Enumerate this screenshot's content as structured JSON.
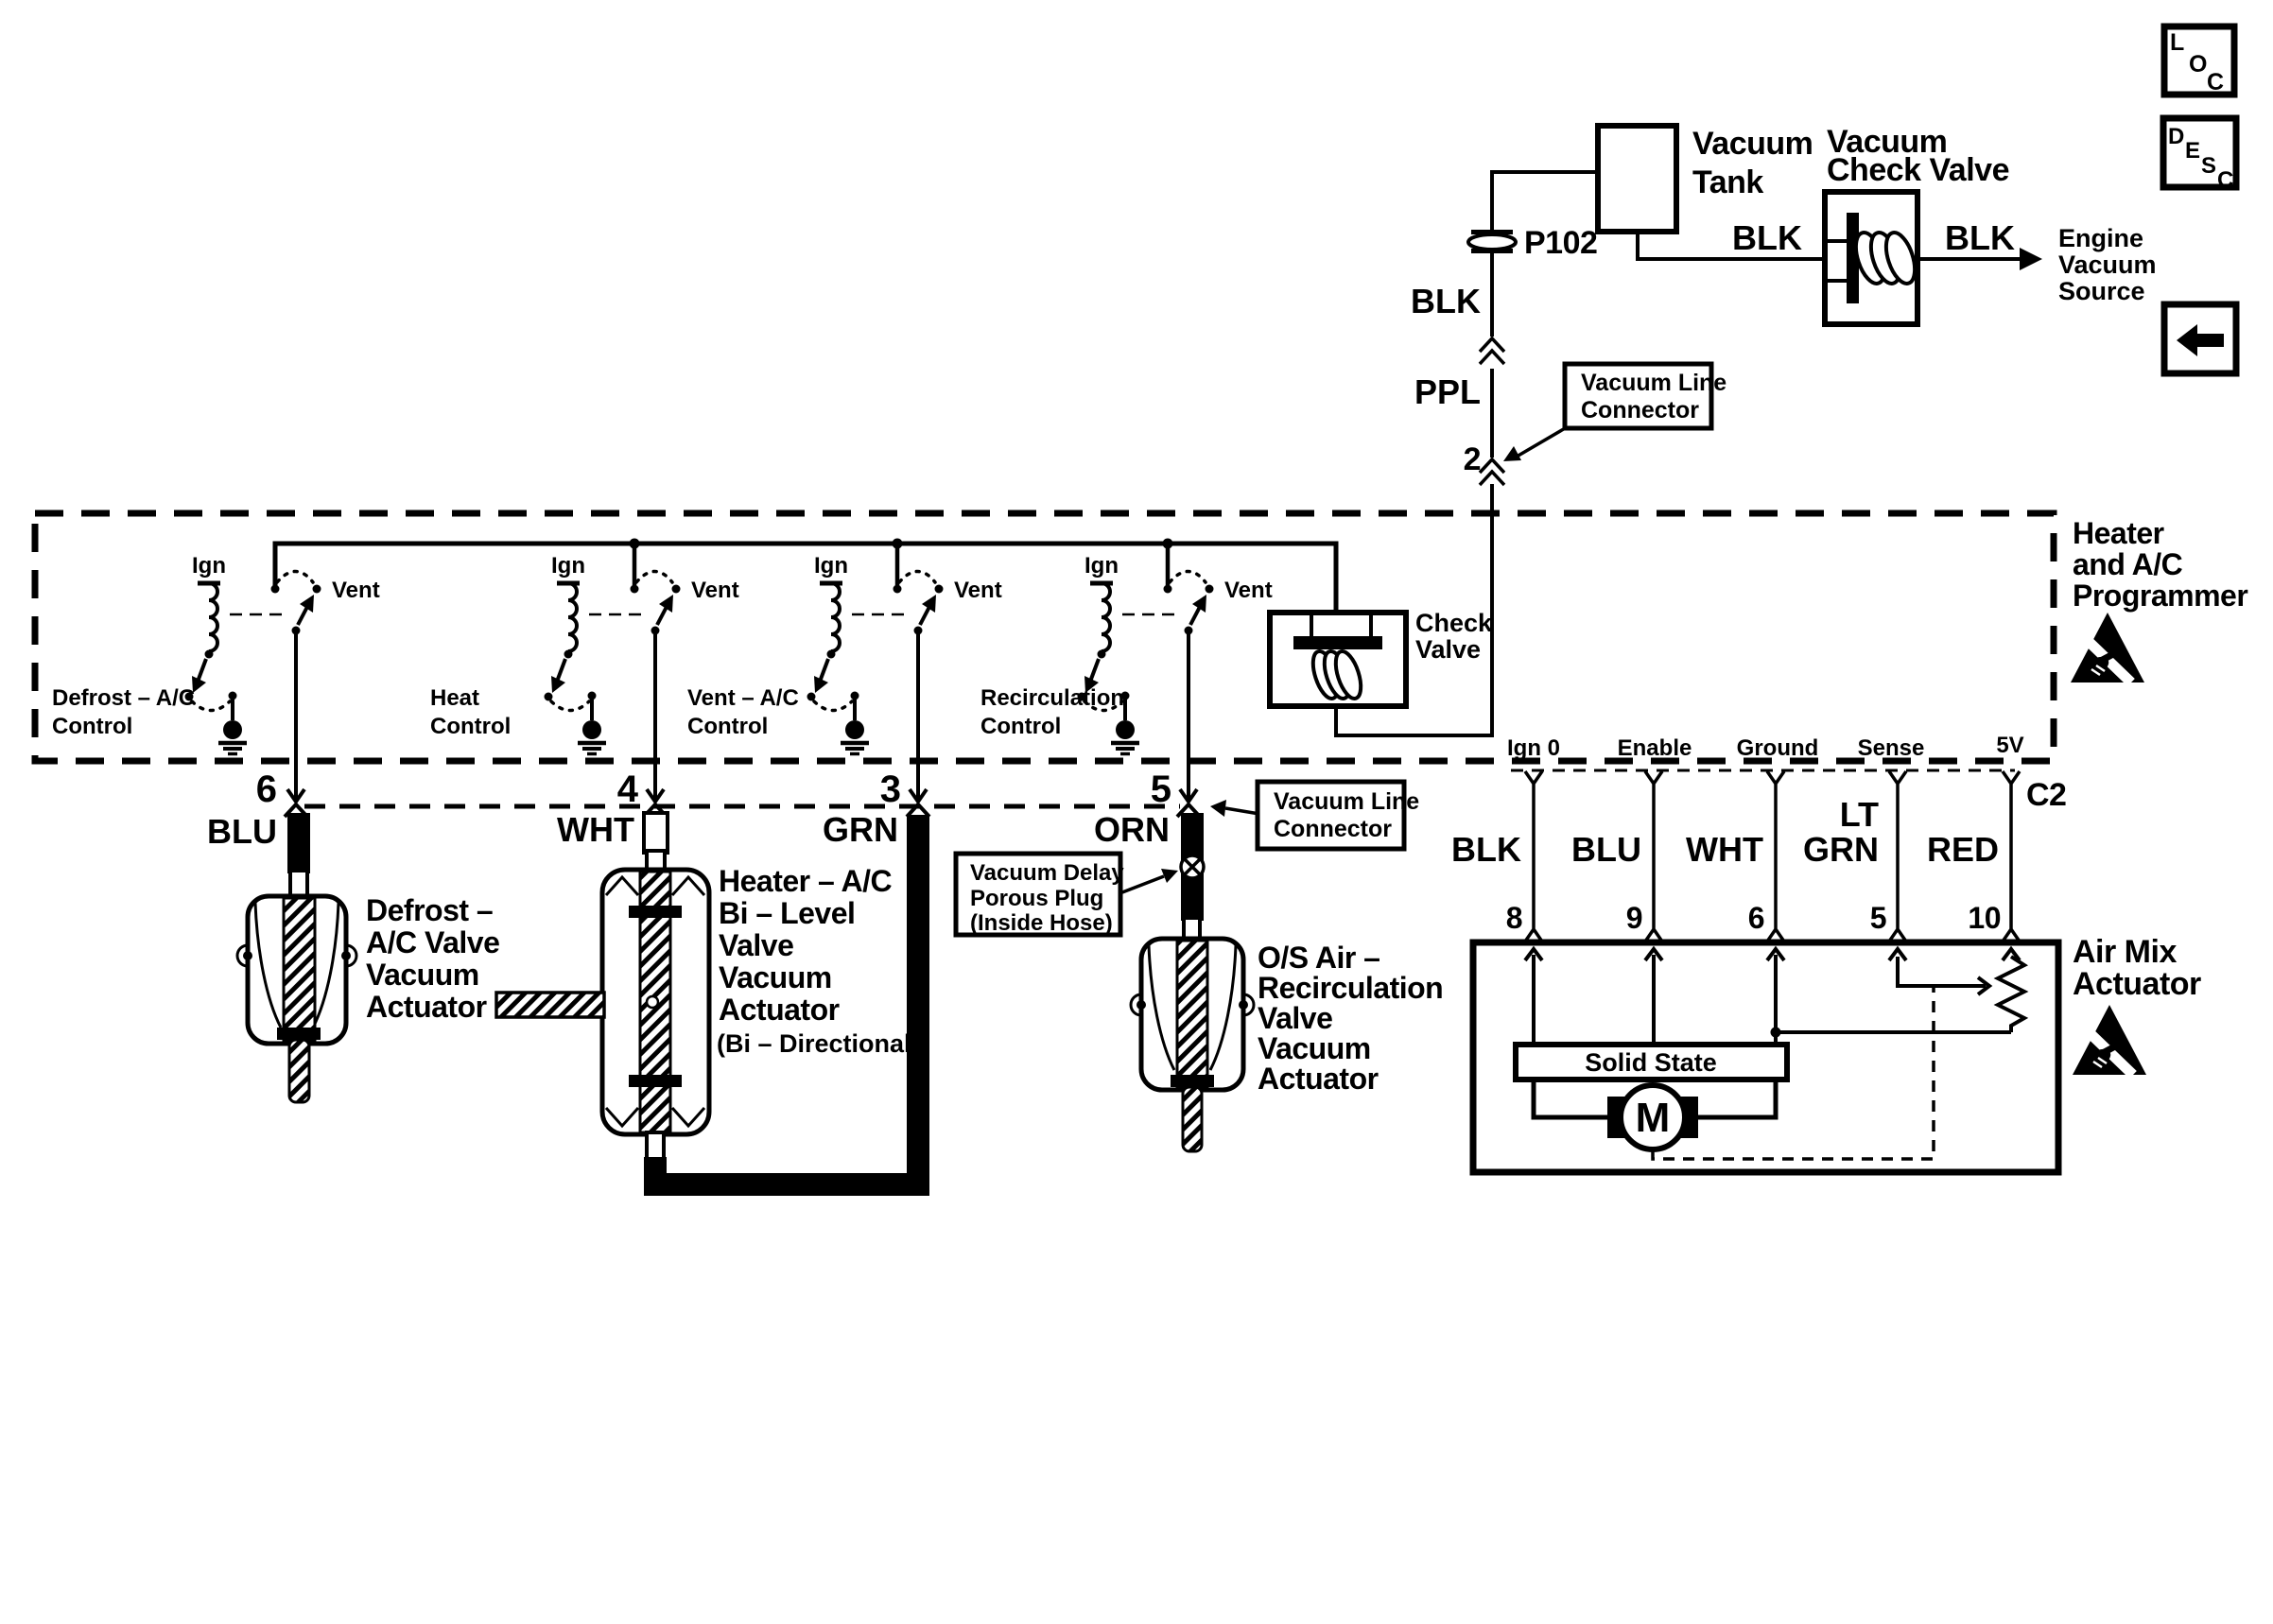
{
  "colors": {
    "ink": "#000000",
    "paper": "#ffffff"
  },
  "buttons": {
    "loc": {
      "letters": [
        "L",
        "O",
        "C"
      ]
    },
    "desc": {
      "letters": [
        "D",
        "E",
        "S",
        "C"
      ]
    },
    "back": {
      "icon": "left-arrow-icon"
    }
  },
  "supply": {
    "tank_label": [
      "Vacuum",
      "Tank"
    ],
    "check_valve_label": [
      "Vacuum",
      "Check Valve"
    ],
    "engine_label": [
      "Engine",
      "Vacuum",
      "Source"
    ],
    "connector": "P102",
    "wire_tank_to_valve": "BLK",
    "wire_valve_to_engine": "BLK",
    "wire_drop": "BLK",
    "wire_ppl": "PPL",
    "port2": "2",
    "callout": {
      "lines": [
        "Vacuum Line",
        "Connector"
      ]
    }
  },
  "programmer": {
    "title": [
      "Heater",
      "and A/C",
      "Programmer"
    ],
    "check_valve_label": [
      "Check",
      "Valve"
    ],
    "units": [
      {
        "ign": "Ign",
        "vent": "Vent",
        "control": [
          "Defrost – A/C",
          "Control"
        ],
        "port": "6",
        "wire": "BLU"
      },
      {
        "ign": "Ign",
        "vent": "Vent",
        "control": [
          "Heat",
          "Control"
        ],
        "port": "4",
        "wire": "WHT"
      },
      {
        "ign": "Ign",
        "vent": "Vent",
        "control": [
          "Vent – A/C",
          "Control"
        ],
        "port": "3",
        "wire": "GRN"
      },
      {
        "ign": "Ign",
        "vent": "Vent",
        "control": [
          "Recirculation",
          "Control"
        ],
        "port": "5",
        "wire": "ORN"
      }
    ]
  },
  "actuators": {
    "defrost": {
      "label": [
        "Defrost –",
        "A/C Valve",
        "Vacuum",
        "Actuator"
      ]
    },
    "bilevel": {
      "label": [
        "Heater – A/C",
        "Bi – Level",
        "Valve",
        "Vacuum",
        "Actuator"
      ],
      "note": "(Bi – Directional)"
    },
    "os_air": {
      "label": [
        "O/S Air –",
        "Recirculation",
        "Valve",
        "Vacuum",
        "Actuator"
      ]
    },
    "porous_callout": {
      "lines": [
        "Vacuum Delay",
        "Porous Plug",
        "(Inside Hose)"
      ]
    },
    "line_callout": {
      "lines": [
        "Vacuum Line",
        "Connector"
      ]
    }
  },
  "air_mix": {
    "title": [
      "Air Mix",
      "Actuator"
    ],
    "connector": "C2",
    "solid_state": "Solid State",
    "motor": "M",
    "pins": [
      {
        "name": "Ign 0",
        "number": "8",
        "wire": [
          "BLK"
        ]
      },
      {
        "name": "Enable",
        "number": "9",
        "wire": [
          "BLU"
        ]
      },
      {
        "name": "Ground",
        "number": "6",
        "wire": [
          "WHT"
        ]
      },
      {
        "name": "Sense",
        "number": "5",
        "wire": [
          "LT",
          "GRN"
        ]
      },
      {
        "name": "5V",
        "number": "10",
        "wire": [
          "RED"
        ]
      }
    ]
  },
  "icons": {
    "esd": "esd-warning-triangle-icon",
    "back": "left-arrow-icon",
    "ground": "ground-symbol-icon",
    "porous_plug": "crossed-circle-plug-icon",
    "inline_connector": "double-chevron-connector-icon"
  }
}
